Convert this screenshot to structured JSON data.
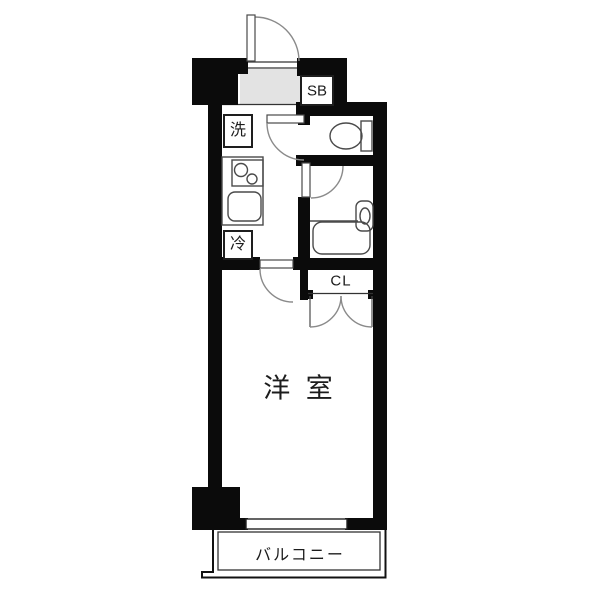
{
  "floorplan": {
    "labels": {
      "shoe_box": "SB",
      "washing_machine": "洗",
      "refrigerator": "冷",
      "closet": "CL",
      "western_room": "洋 室",
      "balcony": "バルコニー"
    },
    "colors": {
      "wall": "#0b0b0b",
      "genkan_floor": "#e3e3e3",
      "fixture_stroke": "#4a4a4a",
      "door_stroke": "#8a8a8a",
      "label_text": "#1c1c1c",
      "background": "#ffffff"
    }
  }
}
